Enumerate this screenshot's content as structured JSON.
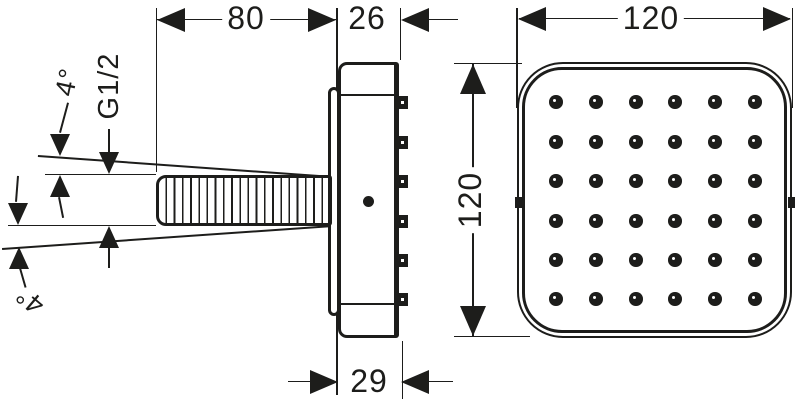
{
  "palette": {
    "ink": "#1d1d1b",
    "paper": "#ffffff"
  },
  "side_view": {
    "width_dim": "80",
    "depth_dim": "26",
    "base_depth_dim": "29",
    "thread_label": "G1/2",
    "tilt_up_label": "4°",
    "tilt_down_label": "4°",
    "nozzle_side_count": 6
  },
  "front_view": {
    "width_dim": "120",
    "height_dim": "120",
    "nozzle_rows": 6,
    "nozzle_cols": 6
  }
}
